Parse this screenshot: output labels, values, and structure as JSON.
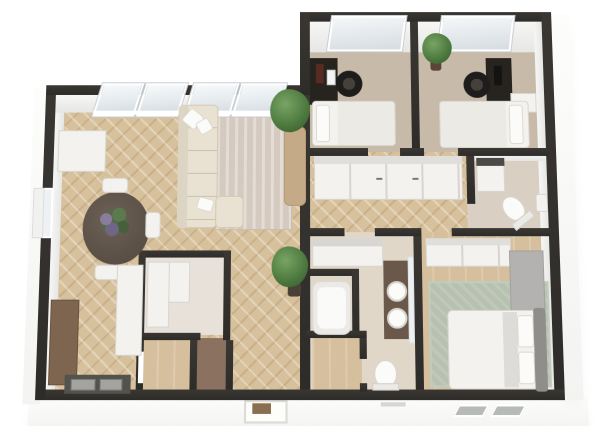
{
  "scene": {
    "title": "3D apartment floor plan render, top-down view",
    "palette": {
      "bg": "#ffffff",
      "wall": "#2e2c29",
      "wood": "#d7c19c",
      "carpet": "#c8baa8",
      "tileBath": "#e0d7c9",
      "tileWc": "#d9d0c3",
      "tileStorage": "#e7e1d9",
      "closetBrown": "#8b7260",
      "rugLiving": "#d5cabf",
      "rugMaster": "#b6c1b0",
      "sofa": "#e9e2d2",
      "furnWhite": "#f3f2ef",
      "furnBorder": "#d9d6d0",
      "deskDark": "#27231f",
      "chairBlack": "#1f1d1b",
      "tableBrown": "#5a4f45",
      "counterWood": "#7d6550",
      "counterDark": "#53524d",
      "steel": "#a3a3a0",
      "vanityBrown": "#6a594b",
      "mirror": "#edf0f2",
      "plant": "#4e7b40",
      "plantLight": "#79a465",
      "pot": "#c4aa87",
      "potDark": "#4a4036",
      "headboard": "#8f8e8b",
      "cabinetGray": "#b3b2b0",
      "mat": "#8a6e50"
    },
    "rooms": [
      {
        "id": "living-dining-kitchen",
        "floor": "herringbone-wood"
      },
      {
        "id": "bedroom-1",
        "floor": "carpet"
      },
      {
        "id": "bedroom-2",
        "floor": "carpet"
      },
      {
        "id": "hallway",
        "floor": "herringbone-wood"
      },
      {
        "id": "wc-laundry",
        "floor": "tile"
      },
      {
        "id": "bathroom",
        "floor": "tile"
      },
      {
        "id": "master-bedroom",
        "floor": "wood-plus-rug"
      },
      {
        "id": "storage-room",
        "floor": "tile"
      },
      {
        "id": "closet-a",
        "floor": "wood"
      },
      {
        "id": "closet-b",
        "floor": "brown"
      },
      {
        "id": "closet-c",
        "floor": "wood"
      }
    ],
    "furniture": [
      "l-shaped-sofa",
      "striped-area-rug",
      "tall-potted-plant",
      "floor-plant",
      "round-dining-table",
      "flower-centerpiece",
      "three-dining-chairs",
      "kitchen-counter",
      "kitchen-sink",
      "white-island",
      "white-cabinet",
      "single-bed-1",
      "desk-1",
      "monitor-1",
      "office-chair-1",
      "single-bed-2",
      "desk-2",
      "monitor-2",
      "office-chair-2",
      "nightstand",
      "plant-bedroom-2",
      "hall-wardrobes",
      "washing-machine",
      "wc-toilet",
      "wc-sink",
      "bath-cabinet",
      "bathtub",
      "double-sink-vanity",
      "mirror",
      "bath-toilet",
      "master-wardrobe",
      "gray-cabinet",
      "double-bed",
      "headboard",
      "sage-rug",
      "front-door",
      "door-mat",
      "windows"
    ]
  }
}
